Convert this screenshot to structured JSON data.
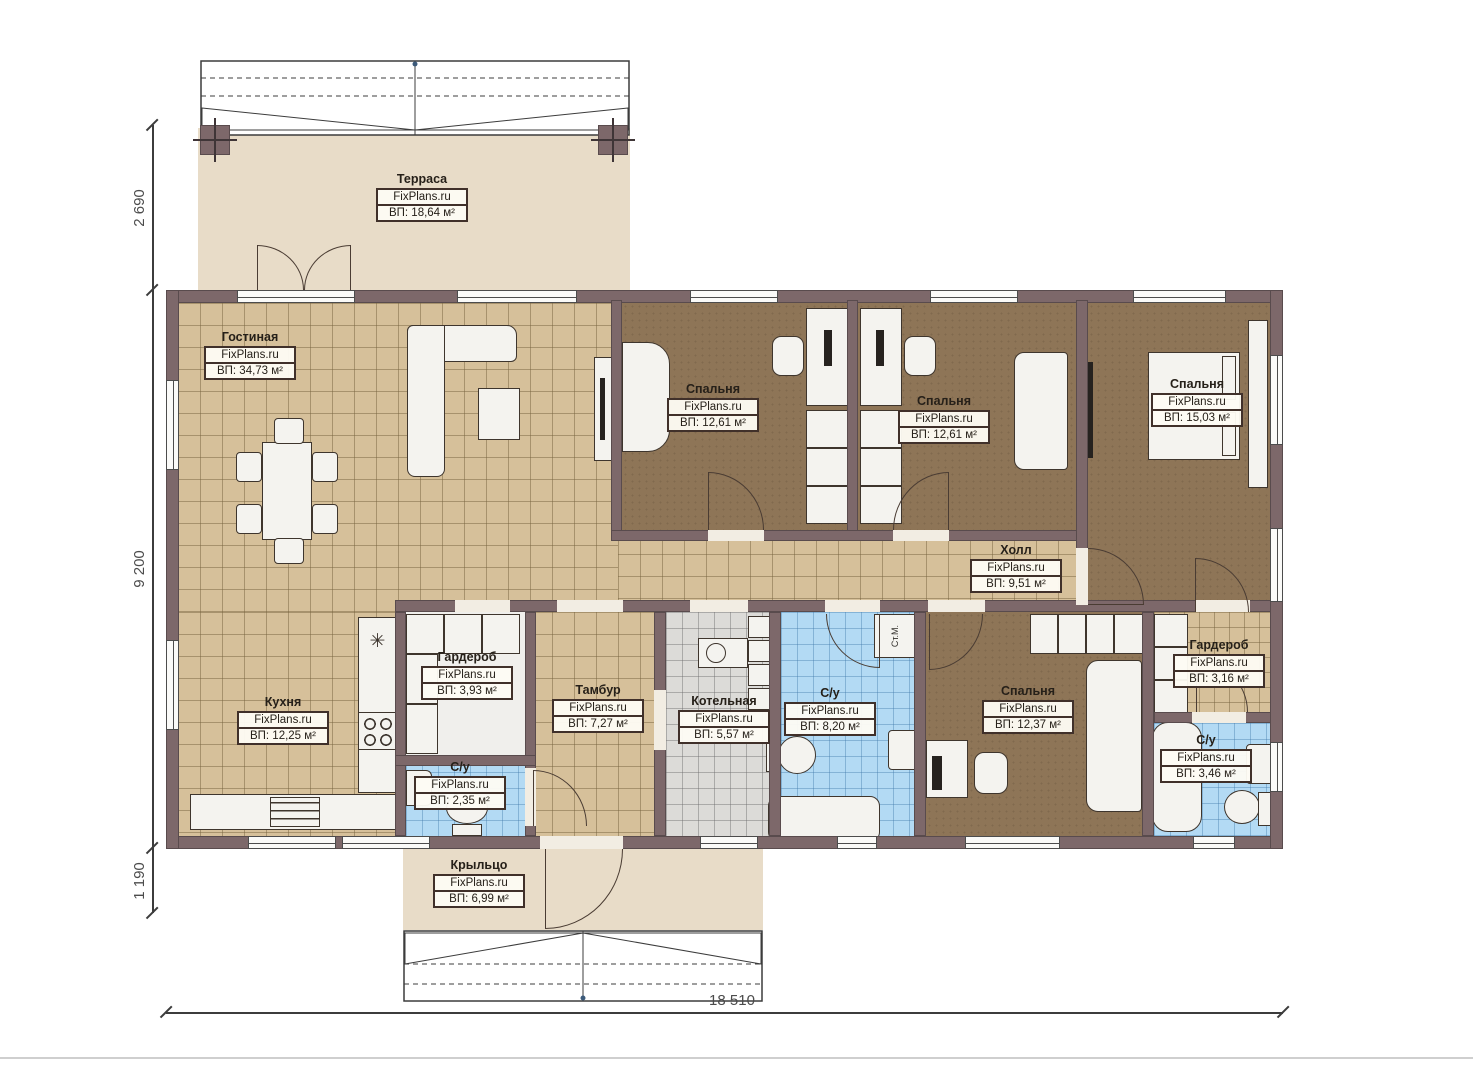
{
  "brand": "FixPlans.ru",
  "rooms": [
    {
      "id": "terrace",
      "name": "Терраса",
      "area": "ВП: 18,64 м²"
    },
    {
      "id": "living",
      "name": "Гостиная",
      "area": "ВП: 34,73 м²"
    },
    {
      "id": "bedroom1",
      "name": "Спальня",
      "area": "ВП: 12,61 м²"
    },
    {
      "id": "bedroom2",
      "name": "Спальня",
      "area": "ВП: 12,61 м²"
    },
    {
      "id": "bedroom3",
      "name": "Спальня",
      "area": "ВП: 15,03 м²"
    },
    {
      "id": "hall",
      "name": "Холл",
      "area": "ВП: 9,51 м²"
    },
    {
      "id": "wardrobe1",
      "name": "Гардероб",
      "area": "ВП: 3,93 м²"
    },
    {
      "id": "kitchen",
      "name": "Кухня",
      "area": "ВП: 12,25 м²"
    },
    {
      "id": "bath-small",
      "name": "С/у",
      "area": "ВП: 2,35 м²"
    },
    {
      "id": "vestibule",
      "name": "Тамбур",
      "area": "ВП: 7,27 м²"
    },
    {
      "id": "boiler",
      "name": "Котельная",
      "area": "ВП: 5,57 м²"
    },
    {
      "id": "bath-main",
      "name": "С/у",
      "area": "ВП: 8,20 м²"
    },
    {
      "id": "bedroom4",
      "name": "Спальня",
      "area": "ВП: 12,37 м²"
    },
    {
      "id": "wardrobe2",
      "name": "Гардероб",
      "area": "ВП: 3,16 м²"
    },
    {
      "id": "bath2",
      "name": "С/у",
      "area": "ВП: 3,46 м²"
    },
    {
      "id": "porch",
      "name": "Крыльцо",
      "area": "ВП: 6,99 м²"
    }
  ],
  "dimensions": {
    "left_top": "2 690",
    "left_middle": "9 200",
    "left_bottom": "1 190",
    "bottom": "18 510"
  },
  "annotations": {
    "washing_machine": "Ст.М."
  },
  "colors": {
    "wall": "#7d686a",
    "tile_tan": "#d6c09a",
    "floor_brown": "#8e7557",
    "tile_blue": "#b3daf4",
    "tile_gray": "#dcdbd8",
    "terrace_beige": "#e8dcc8"
  }
}
